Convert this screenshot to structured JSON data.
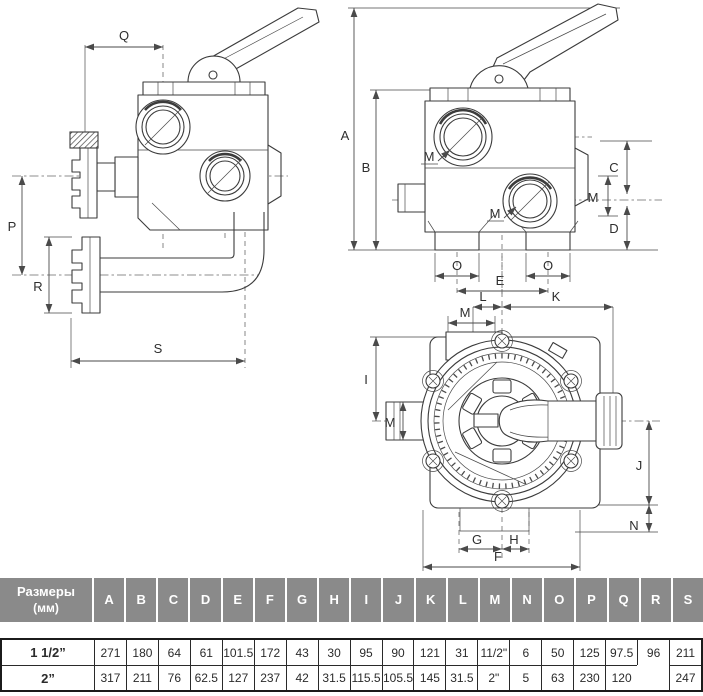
{
  "page": {
    "background": "#ffffff"
  },
  "drawing": {
    "type": "valve-technical-diagram",
    "views": [
      "side-view",
      "front-view",
      "top-view"
    ],
    "dims": {
      "a": "A",
      "b": "B",
      "c": "C",
      "d": "D",
      "e": "E",
      "f": "F",
      "g": "G",
      "h": "H",
      "i": "I",
      "j": "J",
      "k": "K",
      "l": "L",
      "m": "M",
      "n": "N",
      "o": "O",
      "p": "P",
      "q": "Q",
      "r": "R",
      "s": "S"
    }
  },
  "table": {
    "corner_title_line1": "Размеры",
    "corner_title_line2": "(мм)",
    "header_bg": "#8a8a8a",
    "columns": [
      "A",
      "B",
      "C",
      "D",
      "E",
      "F",
      "G",
      "H",
      "I",
      "J",
      "K",
      "L",
      "M",
      "N",
      "O",
      "P",
      "Q",
      "R",
      "S"
    ],
    "merged_column": "R",
    "merged_value": "96",
    "rows": [
      {
        "label": "1 1/2”",
        "values": {
          "A": "271",
          "B": "180",
          "C": "64",
          "D": "61",
          "E": "101.5",
          "F": "172",
          "G": "43",
          "H": "30",
          "I": "95",
          "J": "90",
          "K": "121",
          "L": "31",
          "M": "11/2\"",
          "N": "6",
          "O": "50",
          "P": "125",
          "Q": "97.5",
          "S": "211"
        }
      },
      {
        "label": "2”",
        "values": {
          "A": "317",
          "B": "211",
          "C": "76",
          "D": "62.5",
          "E": "127",
          "F": "237",
          "G": "42",
          "H": "31.5",
          "I": "115.5",
          "J": "105.5",
          "K": "145",
          "L": "31.5",
          "M": "2\"",
          "N": "5",
          "O": "63",
          "P": "230",
          "Q": "120",
          "S": "247"
        }
      }
    ]
  }
}
